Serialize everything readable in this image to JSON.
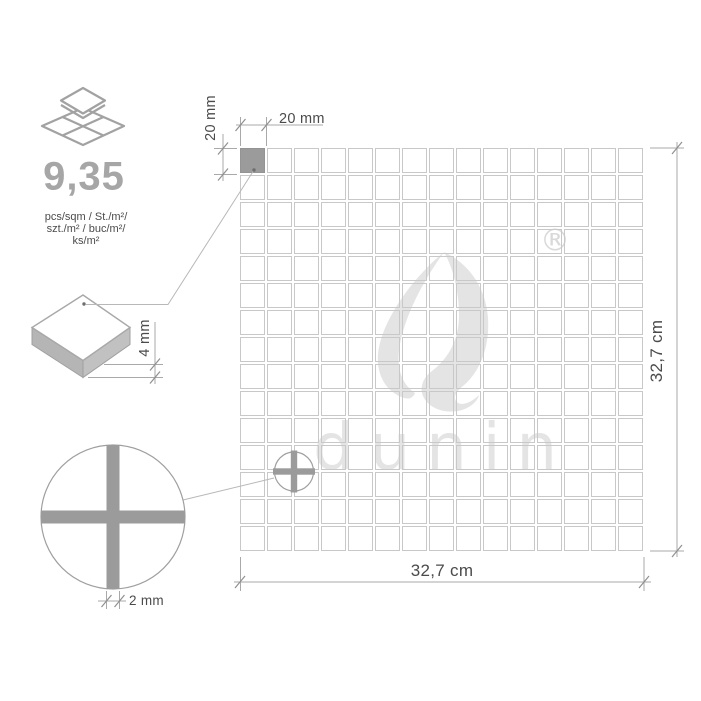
{
  "panel": {
    "pieces_per_sqm": "9,35",
    "units": [
      "pcs/sqm / St./m²/",
      "szt./m² / buc/m²/",
      "ks/m²"
    ]
  },
  "dimensions": {
    "chip_width": "20 mm",
    "chip_height": "20 mm",
    "chip_thickness": "4 mm",
    "joint_width": "2 mm",
    "sheet_width": "32,7 cm",
    "sheet_height": "32,7 cm"
  },
  "mosaic": {
    "rows": 15,
    "cols": 15,
    "highlight_cell": 0
  },
  "watermark": {
    "brand": "dunin",
    "registered": "®"
  },
  "colors": {
    "chip_fill": "#9b9b9b",
    "grid_line": "#c8c8c8",
    "dim_line": "#a9a9a9",
    "label_text": "#4b4b4b",
    "muted_value": "#a6a6a6",
    "watermark": "#e4e4e4"
  }
}
